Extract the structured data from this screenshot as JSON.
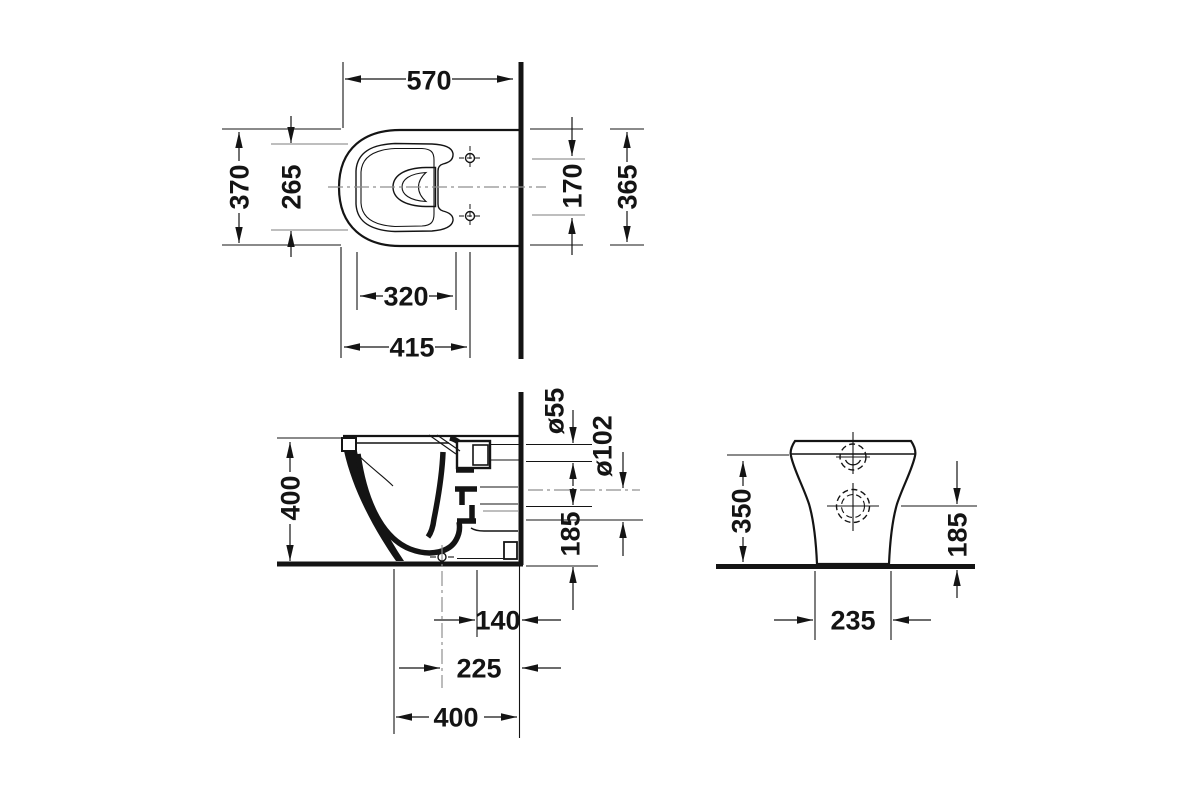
{
  "page": {
    "background": "#ffffff",
    "ink": "#141414",
    "muted_line": "#a8a8a8"
  },
  "drawing": {
    "views": {
      "top": {
        "dims": {
          "depth": "570",
          "overall_width": "370",
          "rim_inner_width": "265",
          "seat_cutout_length": "320",
          "front_to_hinge_holes": "415",
          "hinge_hole_spacing": "170",
          "overall_width_right": "365"
        }
      },
      "side": {
        "dims": {
          "height": "400",
          "inlet_diameter": "ø55",
          "outlet_diameter": "ø102",
          "outlet_height": "185",
          "outlet_to_wall": "140",
          "drain_to_wall": "225",
          "base_depth": "400"
        }
      },
      "back": {
        "dims": {
          "body_height": "350",
          "outlet_height": "185",
          "base_width": "235"
        }
      }
    }
  }
}
